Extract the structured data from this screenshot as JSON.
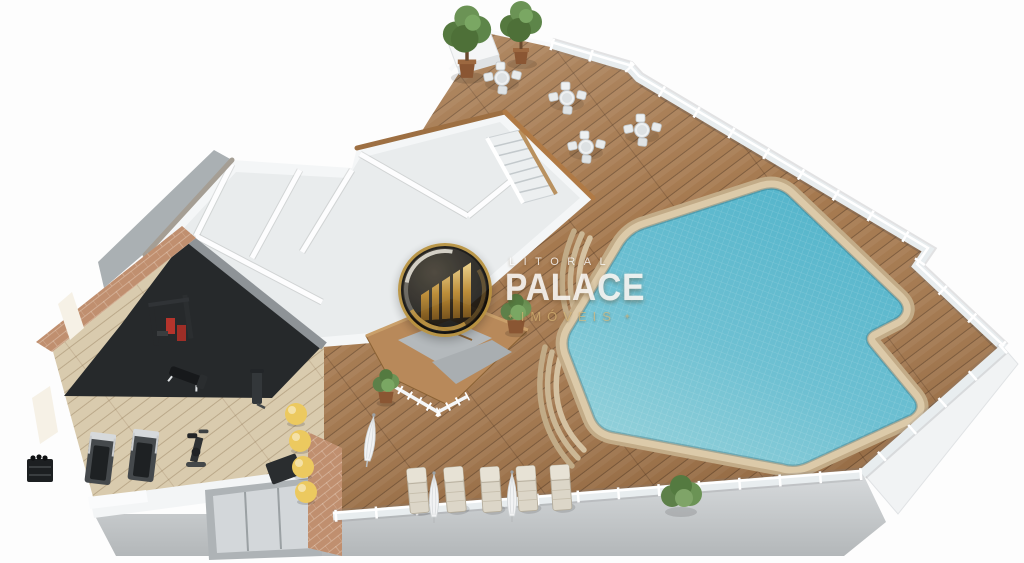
{
  "watermark": {
    "brand_top": "LITORAL",
    "brand_main": "PALACE",
    "brand_sub": "IMÓVEIS",
    "ornament": "✦"
  },
  "scene": {
    "description": "3D isometric floor-plan render of a leisure level: free-form swimming pool on a wood deck with glass railings, terrace seating, gym, changing rooms and sauna",
    "areas": [
      "terrace-seating",
      "pool-deck",
      "swimming-pool",
      "changing-rooms",
      "stairs",
      "sauna",
      "gym",
      "sun-lounger-deck"
    ],
    "counts": {
      "terrace_table_sets": 4,
      "potted_trees": 2,
      "sun_loungers": 5,
      "closed_umbrellas": 3,
      "treadmills": 2,
      "exercise_balls": 4,
      "sauna_plants": 2
    },
    "items": [
      {
        "s": "multigym",
        "x": 172,
        "y": 322
      },
      {
        "s": "bench",
        "x": 186,
        "y": 376,
        "rot": 20
      },
      {
        "s": "cable",
        "x": 257,
        "y": 388
      },
      {
        "s": "treadmill",
        "x": 100,
        "y": 461,
        "rot": 7
      },
      {
        "s": "treadmill",
        "x": 143,
        "y": 458,
        "rot": 7
      },
      {
        "s": "bike",
        "x": 196,
        "y": 452,
        "sc": 1.25
      },
      {
        "s": "rack",
        "x": 40,
        "y": 471
      },
      {
        "s": "mat",
        "x": 284,
        "y": 469,
        "rot": -20
      },
      {
        "s": "ball",
        "x": 296,
        "y": 414
      },
      {
        "s": "ball",
        "x": 300,
        "y": 441
      },
      {
        "s": "ball",
        "x": 303,
        "y": 467
      },
      {
        "s": "ball",
        "x": 306,
        "y": 492
      },
      {
        "s": "potplant",
        "x": 386,
        "y": 390,
        "sc": 0.95
      },
      {
        "s": "potplant",
        "x": 516,
        "y": 318,
        "sc": 1.1
      },
      {
        "s": "tree",
        "x": 467,
        "y": 48,
        "sc": 1.15
      },
      {
        "s": "tree",
        "x": 521,
        "y": 38
      },
      {
        "s": "tableset",
        "x": 502,
        "y": 80
      },
      {
        "s": "tableset",
        "x": 567,
        "y": 100
      },
      {
        "s": "tableset",
        "x": 586,
        "y": 149
      },
      {
        "s": "tableset",
        "x": 642,
        "y": 132
      },
      {
        "s": "umbrella",
        "x": 370,
        "y": 442,
        "rot": 8,
        "sc": 1.05
      },
      {
        "s": "lounger",
        "x": 418,
        "y": 491,
        "rot": -5
      },
      {
        "s": "lounger",
        "x": 455,
        "y": 490,
        "rot": -5
      },
      {
        "s": "lounger",
        "x": 491,
        "y": 490,
        "rot": -4
      },
      {
        "s": "lounger",
        "x": 527,
        "y": 489,
        "rot": -4
      },
      {
        "s": "lounger",
        "x": 561,
        "y": 488,
        "rot": -4
      },
      {
        "s": "umbrella",
        "x": 434,
        "y": 499
      },
      {
        "s": "umbrella",
        "x": 512,
        "y": 498
      },
      {
        "s": "bush",
        "x": 681,
        "y": 494
      }
    ]
  },
  "colors": {
    "deckWood": "#a5794f",
    "gymWood": "#d9cbae",
    "gymMat": "#26292b",
    "brick": "#c08f6f",
    "poolDeep": "#55b5cb",
    "poolShallow": "#94d1da",
    "poolCoping": "#dccaa9",
    "wallWhite": "#f4f6f7",
    "slabGray": "#c6c9cb",
    "glassRail": "#e8edef",
    "plantGreen": "#5d8049",
    "ballYellow": "#ecc95f",
    "loungerBeige": "#dcd6c8",
    "logoGold": "#b8923f",
    "brandGoldText": "#d9b879"
  }
}
